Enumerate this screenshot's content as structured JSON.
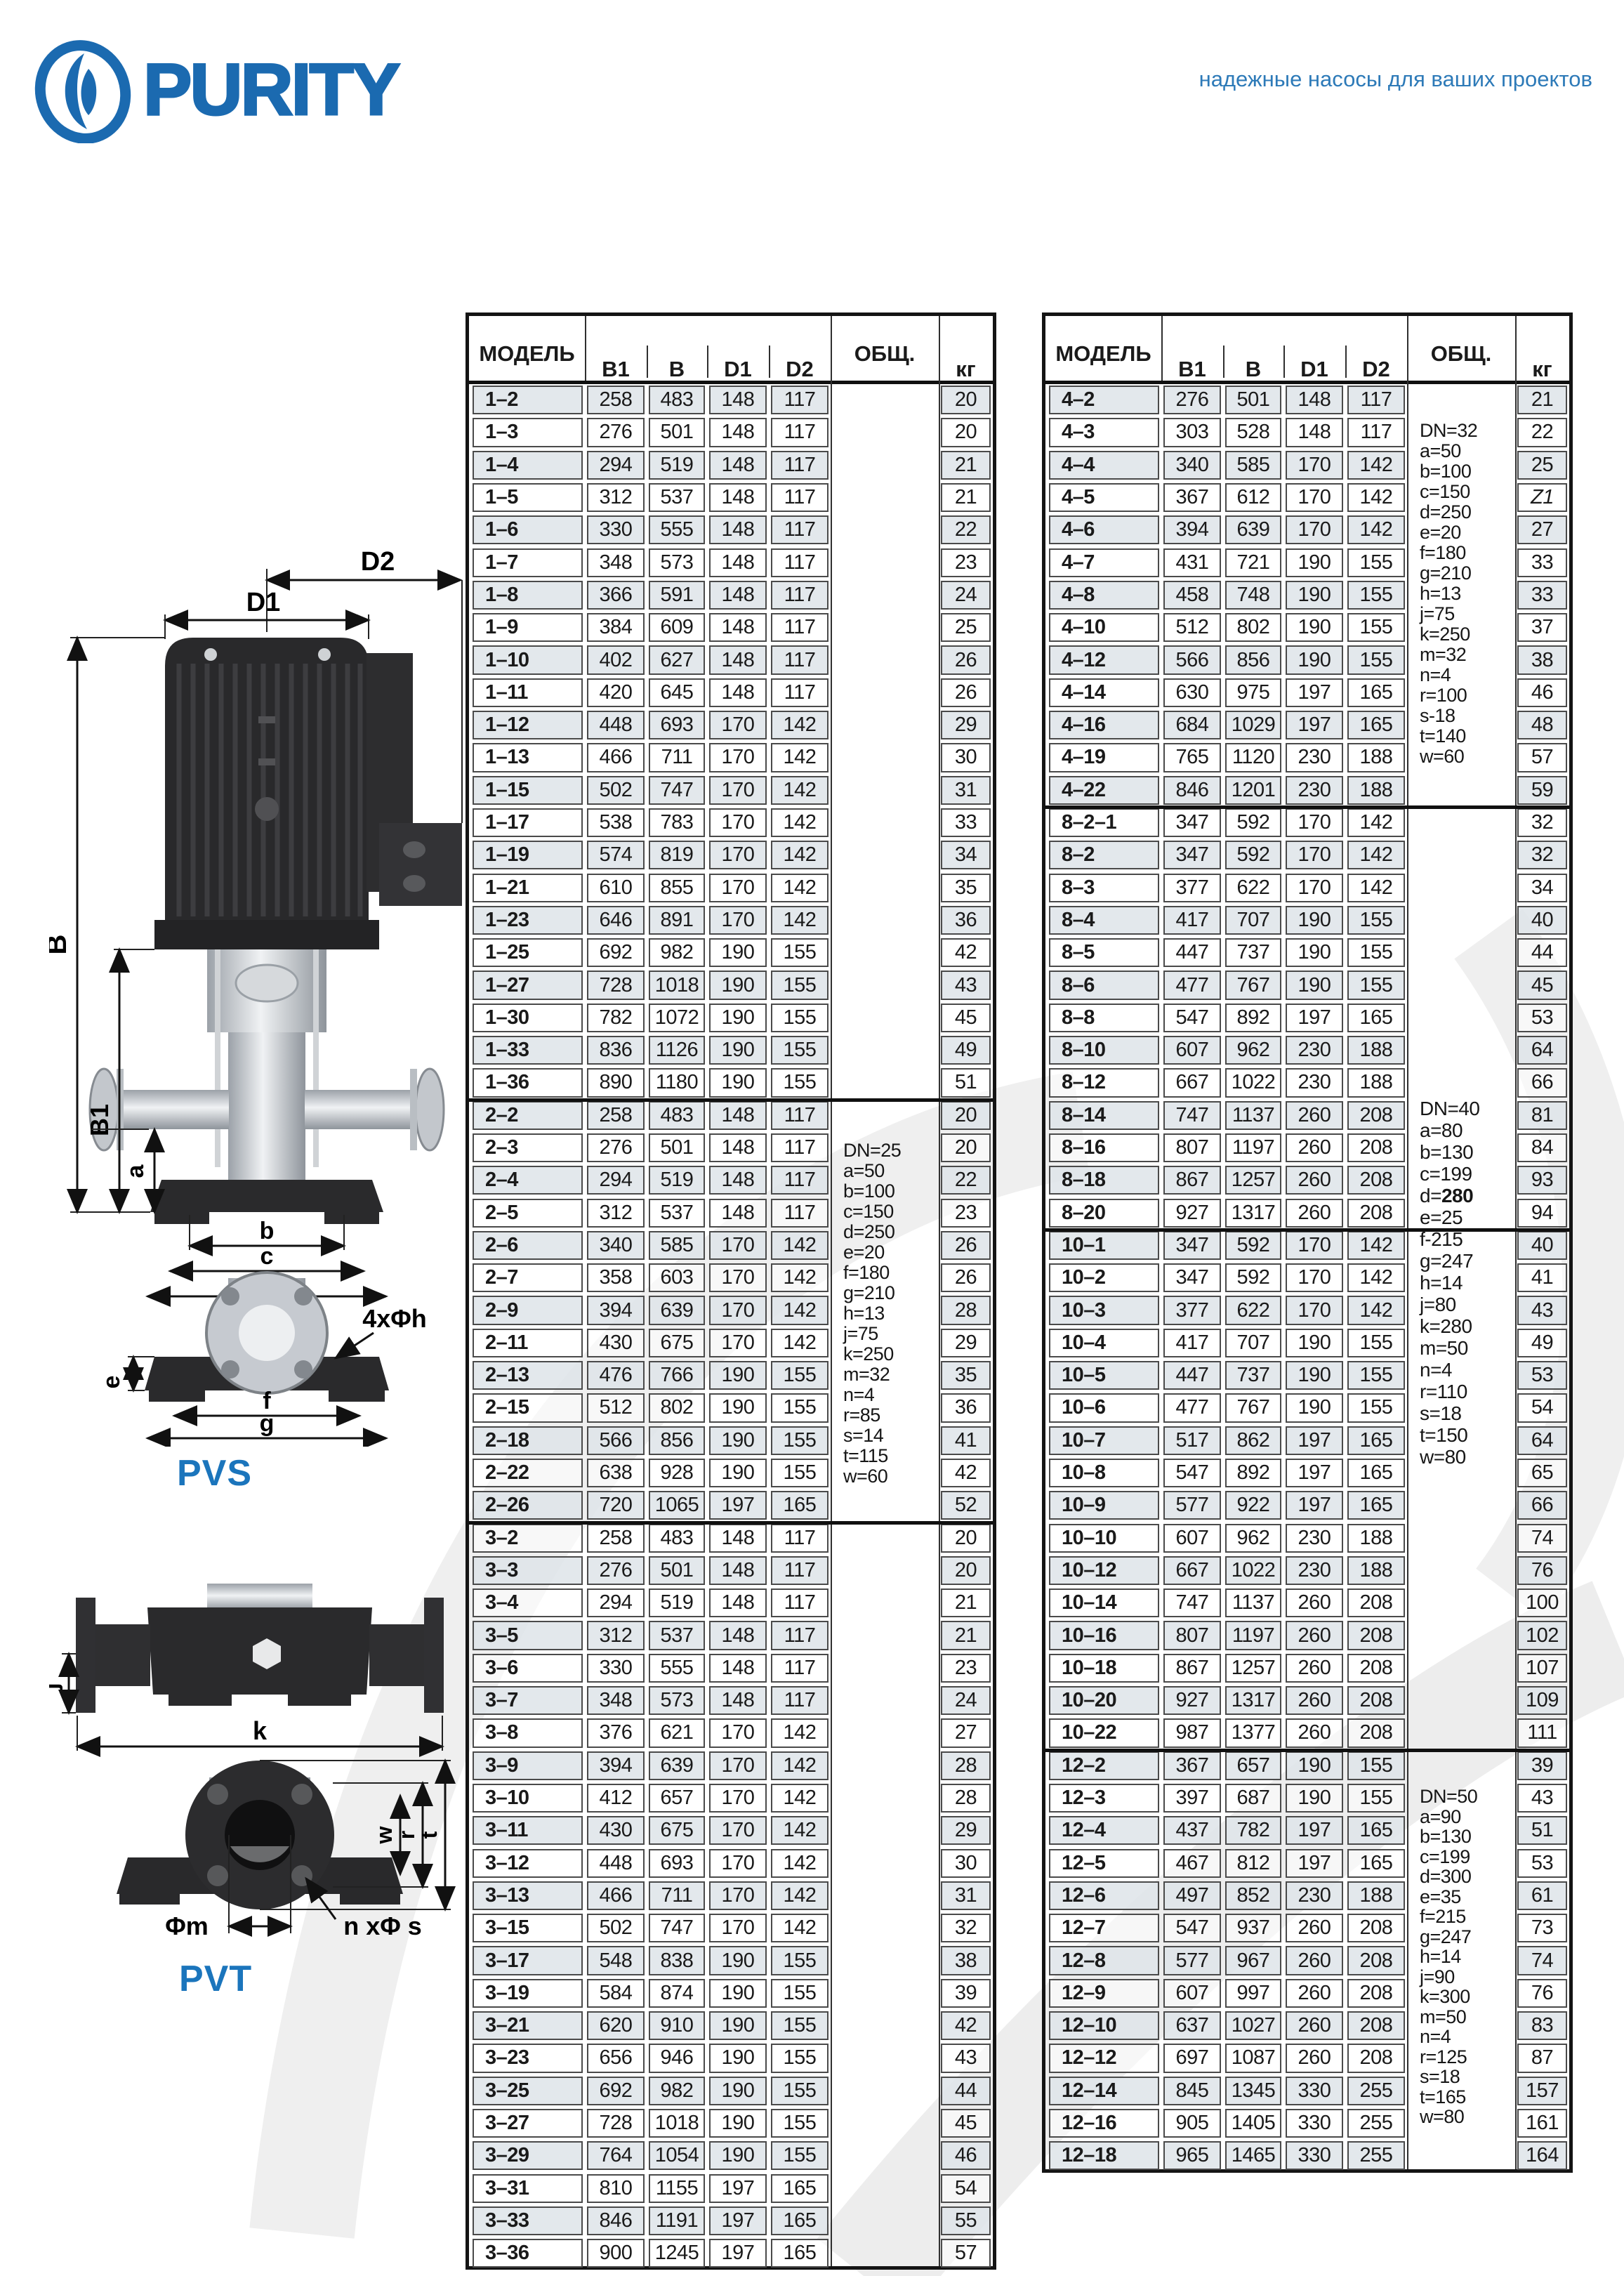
{
  "page": {
    "brand": "PURITY",
    "tagline": "надежные насосы для ваших проектов"
  },
  "columns": {
    "model": "МОДЕЛЬ",
    "b1": "B1",
    "b": "B",
    "d1": "D1",
    "d2": "D2",
    "total": "ОБЩ.",
    "kg": "кг"
  },
  "left_table": {
    "rows": [
      [
        "1–2",
        258,
        483,
        148,
        117,
        20
      ],
      [
        "1–3",
        276,
        501,
        148,
        117,
        20
      ],
      [
        "1–4",
        294,
        519,
        148,
        117,
        21
      ],
      [
        "1–5",
        312,
        537,
        148,
        117,
        21
      ],
      [
        "1–6",
        330,
        555,
        148,
        117,
        22
      ],
      [
        "1–7",
        348,
        573,
        148,
        117,
        23
      ],
      [
        "1–8",
        366,
        591,
        148,
        117,
        24
      ],
      [
        "1–9",
        384,
        609,
        148,
        117,
        25
      ],
      [
        "1–10",
        402,
        627,
        148,
        117,
        26
      ],
      [
        "1–11",
        420,
        645,
        148,
        117,
        26
      ],
      [
        "1–12",
        448,
        693,
        170,
        142,
        29
      ],
      [
        "1–13",
        466,
        711,
        170,
        142,
        30
      ],
      [
        "1–15",
        502,
        747,
        170,
        142,
        31
      ],
      [
        "1–17",
        538,
        783,
        170,
        142,
        33
      ],
      [
        "1–19",
        574,
        819,
        170,
        142,
        34
      ],
      [
        "1–21",
        610,
        855,
        170,
        142,
        35
      ],
      [
        "1–23",
        646,
        891,
        170,
        142,
        36
      ],
      [
        "1–25",
        692,
        982,
        190,
        155,
        42
      ],
      [
        "1–27",
        728,
        1018,
        190,
        155,
        43
      ],
      [
        "1–30",
        782,
        1072,
        190,
        155,
        45
      ],
      [
        "1–33",
        836,
        1126,
        190,
        155,
        49
      ],
      [
        "1–36",
        890,
        1180,
        190,
        155,
        51
      ],
      [
        "2–2",
        258,
        483,
        148,
        117,
        20
      ],
      [
        "2–3",
        276,
        501,
        148,
        117,
        20
      ],
      [
        "2–4",
        294,
        519,
        148,
        117,
        22
      ],
      [
        "2–5",
        312,
        537,
        148,
        117,
        23
      ],
      [
        "2–6",
        340,
        585,
        170,
        142,
        26
      ],
      [
        "2–7",
        358,
        603,
        170,
        142,
        26
      ],
      [
        "2–9",
        394,
        639,
        170,
        142,
        28
      ],
      [
        "2–11",
        430,
        675,
        170,
        142,
        29
      ],
      [
        "2–13",
        476,
        766,
        190,
        155,
        35
      ],
      [
        "2–15",
        512,
        802,
        190,
        155,
        36
      ],
      [
        "2–18",
        566,
        856,
        190,
        155,
        41
      ],
      [
        "2–22",
        638,
        928,
        190,
        155,
        42
      ],
      [
        "2–26",
        720,
        1065,
        197,
        165,
        52
      ],
      [
        "3–2",
        258,
        483,
        148,
        117,
        20
      ],
      [
        "3–3",
        276,
        501,
        148,
        117,
        20
      ],
      [
        "3–4",
        294,
        519,
        148,
        117,
        21
      ],
      [
        "3–5",
        312,
        537,
        148,
        117,
        21
      ],
      [
        "3–6",
        330,
        555,
        148,
        117,
        23
      ],
      [
        "3–7",
        348,
        573,
        148,
        117,
        24
      ],
      [
        "3–8",
        376,
        621,
        170,
        142,
        27
      ],
      [
        "3–9",
        394,
        639,
        170,
        142,
        28
      ],
      [
        "3–10",
        412,
        657,
        170,
        142,
        28
      ],
      [
        "3–11",
        430,
        675,
        170,
        142,
        29
      ],
      [
        "3–12",
        448,
        693,
        170,
        142,
        30
      ],
      [
        "3–13",
        466,
        711,
        170,
        142,
        31
      ],
      [
        "3–15",
        502,
        747,
        170,
        142,
        32
      ],
      [
        "3–17",
        548,
        838,
        190,
        155,
        38
      ],
      [
        "3–19",
        584,
        874,
        190,
        155,
        39
      ],
      [
        "3–21",
        620,
        910,
        190,
        155,
        42
      ],
      [
        "3–23",
        656,
        946,
        190,
        155,
        43
      ],
      [
        "3–25",
        692,
        982,
        190,
        155,
        44
      ],
      [
        "3–27",
        728,
        1018,
        190,
        155,
        45
      ],
      [
        "3–29",
        764,
        1054,
        190,
        155,
        46
      ],
      [
        "3–31",
        810,
        1155,
        197,
        165,
        54
      ],
      [
        "3–33",
        846,
        1191,
        197,
        165,
        55
      ],
      [
        "3–36",
        900,
        1245,
        197,
        165,
        57
      ]
    ],
    "section_breaks": [
      22,
      35
    ],
    "spec_blocks": [
      {
        "id": "dn25",
        "lines": [
          "DN=25",
          "a=50",
          "b=100",
          "c=150",
          "d=250",
          "e=20",
          "f=180",
          "g=210",
          "h=13",
          "j=75",
          "k=250",
          "m=32",
          "n=4",
          "r=85",
          "s=14",
          "t=115",
          "w=60"
        ]
      }
    ]
  },
  "right_table": {
    "rows": [
      [
        "4–2",
        276,
        501,
        148,
        117,
        21
      ],
      [
        "4–3",
        303,
        528,
        148,
        117,
        22
      ],
      [
        "4–4",
        340,
        585,
        170,
        142,
        25
      ],
      [
        "4–5",
        367,
        612,
        170,
        142,
        "Z1"
      ],
      [
        "4–6",
        394,
        639,
        170,
        142,
        27
      ],
      [
        "4–7",
        431,
        721,
        190,
        155,
        33
      ],
      [
        "4–8",
        458,
        748,
        190,
        155,
        33
      ],
      [
        "4–10",
        512,
        802,
        190,
        155,
        37
      ],
      [
        "4–12",
        566,
        856,
        190,
        155,
        38
      ],
      [
        "4–14",
        630,
        975,
        197,
        165,
        46
      ],
      [
        "4–16",
        684,
        1029,
        197,
        165,
        48
      ],
      [
        "4–19",
        765,
        1120,
        230,
        188,
        57
      ],
      [
        "4–22",
        846,
        1201,
        230,
        188,
        59
      ],
      [
        "8–2–1",
        347,
        592,
        170,
        142,
        32
      ],
      [
        "8–2",
        347,
        592,
        170,
        142,
        32
      ],
      [
        "8–3",
        377,
        622,
        170,
        142,
        34
      ],
      [
        "8–4",
        417,
        707,
        190,
        155,
        40
      ],
      [
        "8–5",
        447,
        737,
        190,
        155,
        44
      ],
      [
        "8–6",
        477,
        767,
        190,
        155,
        45
      ],
      [
        "8–8",
        547,
        892,
        197,
        165,
        53
      ],
      [
        "8–10",
        607,
        962,
        230,
        188,
        64
      ],
      [
        "8–12",
        667,
        1022,
        230,
        188,
        66
      ],
      [
        "8–14",
        747,
        1137,
        260,
        208,
        81
      ],
      [
        "8–16",
        807,
        1197,
        260,
        208,
        84
      ],
      [
        "8–18",
        867,
        1257,
        260,
        208,
        93
      ],
      [
        "8–20",
        927,
        1317,
        260,
        208,
        94
      ],
      [
        "10–1",
        347,
        592,
        170,
        142,
        40
      ],
      [
        "10–2",
        347,
        592,
        170,
        142,
        41
      ],
      [
        "10–3",
        377,
        622,
        170,
        142,
        43
      ],
      [
        "10–4",
        417,
        707,
        190,
        155,
        49
      ],
      [
        "10–5",
        447,
        737,
        190,
        155,
        53
      ],
      [
        "10–6",
        477,
        767,
        190,
        155,
        54
      ],
      [
        "10–7",
        517,
        862,
        197,
        165,
        64
      ],
      [
        "10–8",
        547,
        892,
        197,
        165,
        65
      ],
      [
        "10–9",
        577,
        922,
        197,
        165,
        66
      ],
      [
        "10–10",
        607,
        962,
        230,
        188,
        74
      ],
      [
        "10–12",
        667,
        1022,
        230,
        188,
        76
      ],
      [
        "10–14",
        747,
        1137,
        260,
        208,
        100
      ],
      [
        "10–16",
        807,
        1197,
        260,
        208,
        102
      ],
      [
        "10–18",
        867,
        1257,
        260,
        208,
        107
      ],
      [
        "10–20",
        927,
        1317,
        260,
        208,
        109
      ],
      [
        "10–22",
        987,
        1377,
        260,
        208,
        111
      ],
      [
        "12–2",
        367,
        657,
        190,
        155,
        39
      ],
      [
        "12–3",
        397,
        687,
        190,
        155,
        43
      ],
      [
        "12–4",
        437,
        782,
        197,
        165,
        51
      ],
      [
        "12–5",
        467,
        812,
        197,
        165,
        53
      ],
      [
        "12–6",
        497,
        852,
        230,
        188,
        61
      ],
      [
        "12–7",
        547,
        937,
        260,
        208,
        73
      ],
      [
        "12–8",
        577,
        967,
        260,
        208,
        74
      ],
      [
        "12–9",
        607,
        997,
        260,
        208,
        76
      ],
      [
        "12–10",
        637,
        1027,
        260,
        208,
        83
      ],
      [
        "12–12",
        697,
        1087,
        260,
        208,
        87
      ],
      [
        "12–14",
        845,
        1345,
        330,
        255,
        157
      ],
      [
        "12–16",
        905,
        1405,
        330,
        255,
        161
      ],
      [
        "12–18",
        965,
        1465,
        330,
        255,
        164
      ]
    ],
    "section_breaks": [
      13,
      26,
      42
    ],
    "spec_blocks": [
      {
        "id": "dn32",
        "lines": [
          "DN=32",
          "a=50",
          "b=100",
          "c=150",
          "d=250",
          "e=20",
          "f=180",
          "g=210",
          "h=13",
          "j=75",
          "k=250",
          "m=32",
          "n=4",
          "r=100",
          "s-18",
          "t=140",
          "w=60"
        ]
      },
      {
        "id": "dn40",
        "lines": [
          "DN=40",
          "a=80",
          "b=130",
          "c=199",
          "d=280",
          "e=25",
          "f-215",
          "g=247",
          "h=14",
          "j=80",
          "k=280",
          "m=50",
          "n=4",
          "r=110",
          "s=18",
          "t=150",
          "w=80"
        ],
        "bold_d": true
      },
      {
        "id": "dn50",
        "lines": [
          "DN=50",
          "a=90",
          "b=130",
          "c=199",
          "d=300",
          "e=35",
          "f=215",
          "g=247",
          "h=14",
          "j=90",
          "k=300",
          "m=50",
          "n=4",
          "r=125",
          "s=18",
          "t=165",
          "w=80"
        ]
      }
    ]
  },
  "diagrams": {
    "pvs": {
      "label": "PVS",
      "dims": {
        "d1": "D1",
        "d2": "D2",
        "b": "B",
        "b1": "B1",
        "a": "a",
        "bw": "b",
        "c": "c",
        "d": "d",
        "e": "e",
        "f": "f",
        "g": "g",
        "holes": "4xΦh"
      }
    },
    "pvt": {
      "label": "PVT",
      "dims": {
        "j": "j",
        "k": "k",
        "m": "Φm",
        "ns": "n xΦ s",
        "w": "w",
        "r": "r",
        "t": "t"
      }
    }
  },
  "colors": {
    "brand_blue": "#1b6ab0",
    "tagline_blue": "#2d7ab8",
    "row_gray": "#dee4e9",
    "border_dark": "#141414"
  }
}
